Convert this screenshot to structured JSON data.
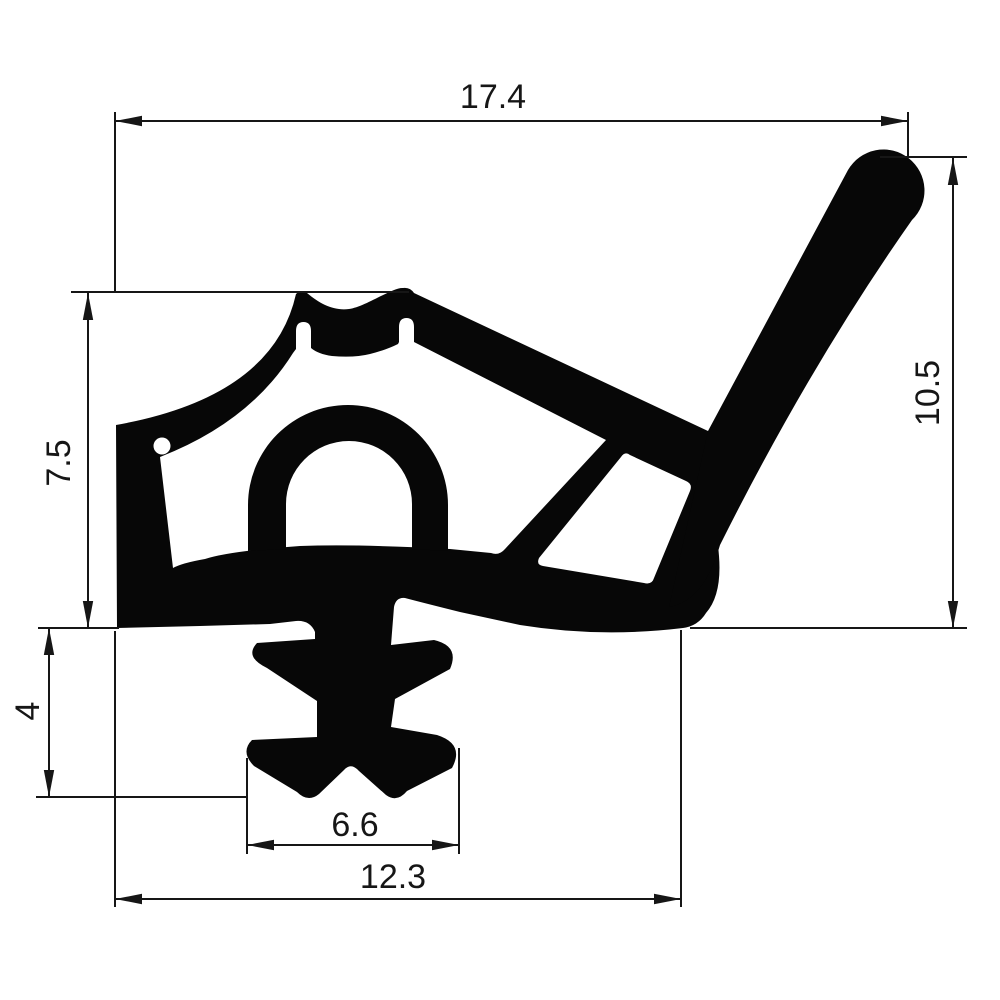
{
  "drawing": {
    "kind": "technical-cross-section",
    "dimensions": {
      "top_width": "17.4",
      "right_height": "10.5",
      "left_height": "7.5",
      "anchor_height": "4",
      "anchor_tip_width": "6.6",
      "bottom_width": "12.3"
    },
    "colors": {
      "ink": "#161616",
      "profile_fill": "#070707",
      "background": "#ffffff"
    }
  }
}
